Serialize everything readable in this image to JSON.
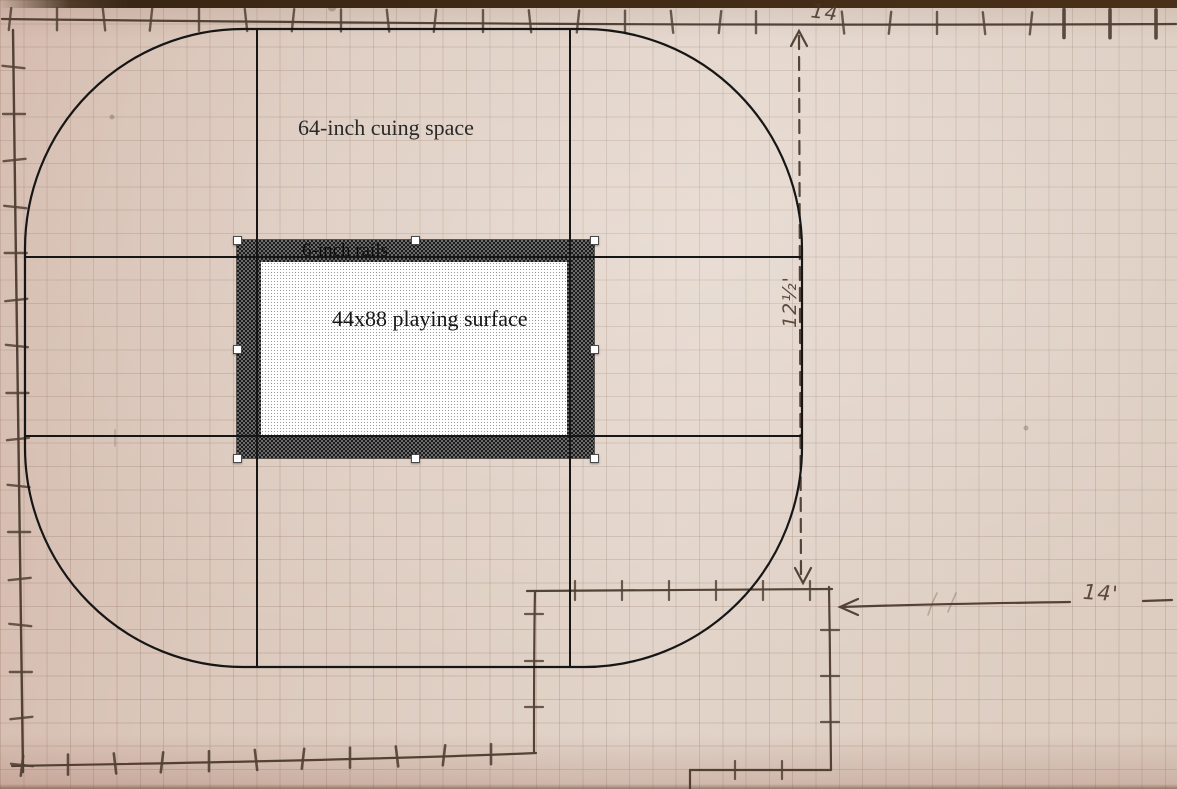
{
  "diagram": {
    "labels": {
      "cuing_space": "64-inch cuing space",
      "rails": "6-inch rails",
      "playing_surface": "44x88 playing surface"
    },
    "dimensions": {
      "top_width": "14",
      "right_height": "12½'",
      "right_offset": "14'"
    },
    "colors": {
      "paper": "#dfcfc3",
      "grid_line": "#927464",
      "pencil": "#47362a",
      "digital_ink": "#161616",
      "rail_fill": "#3f3f3f",
      "surface_fill": "#ededed",
      "handle": "#ffffff"
    }
  }
}
